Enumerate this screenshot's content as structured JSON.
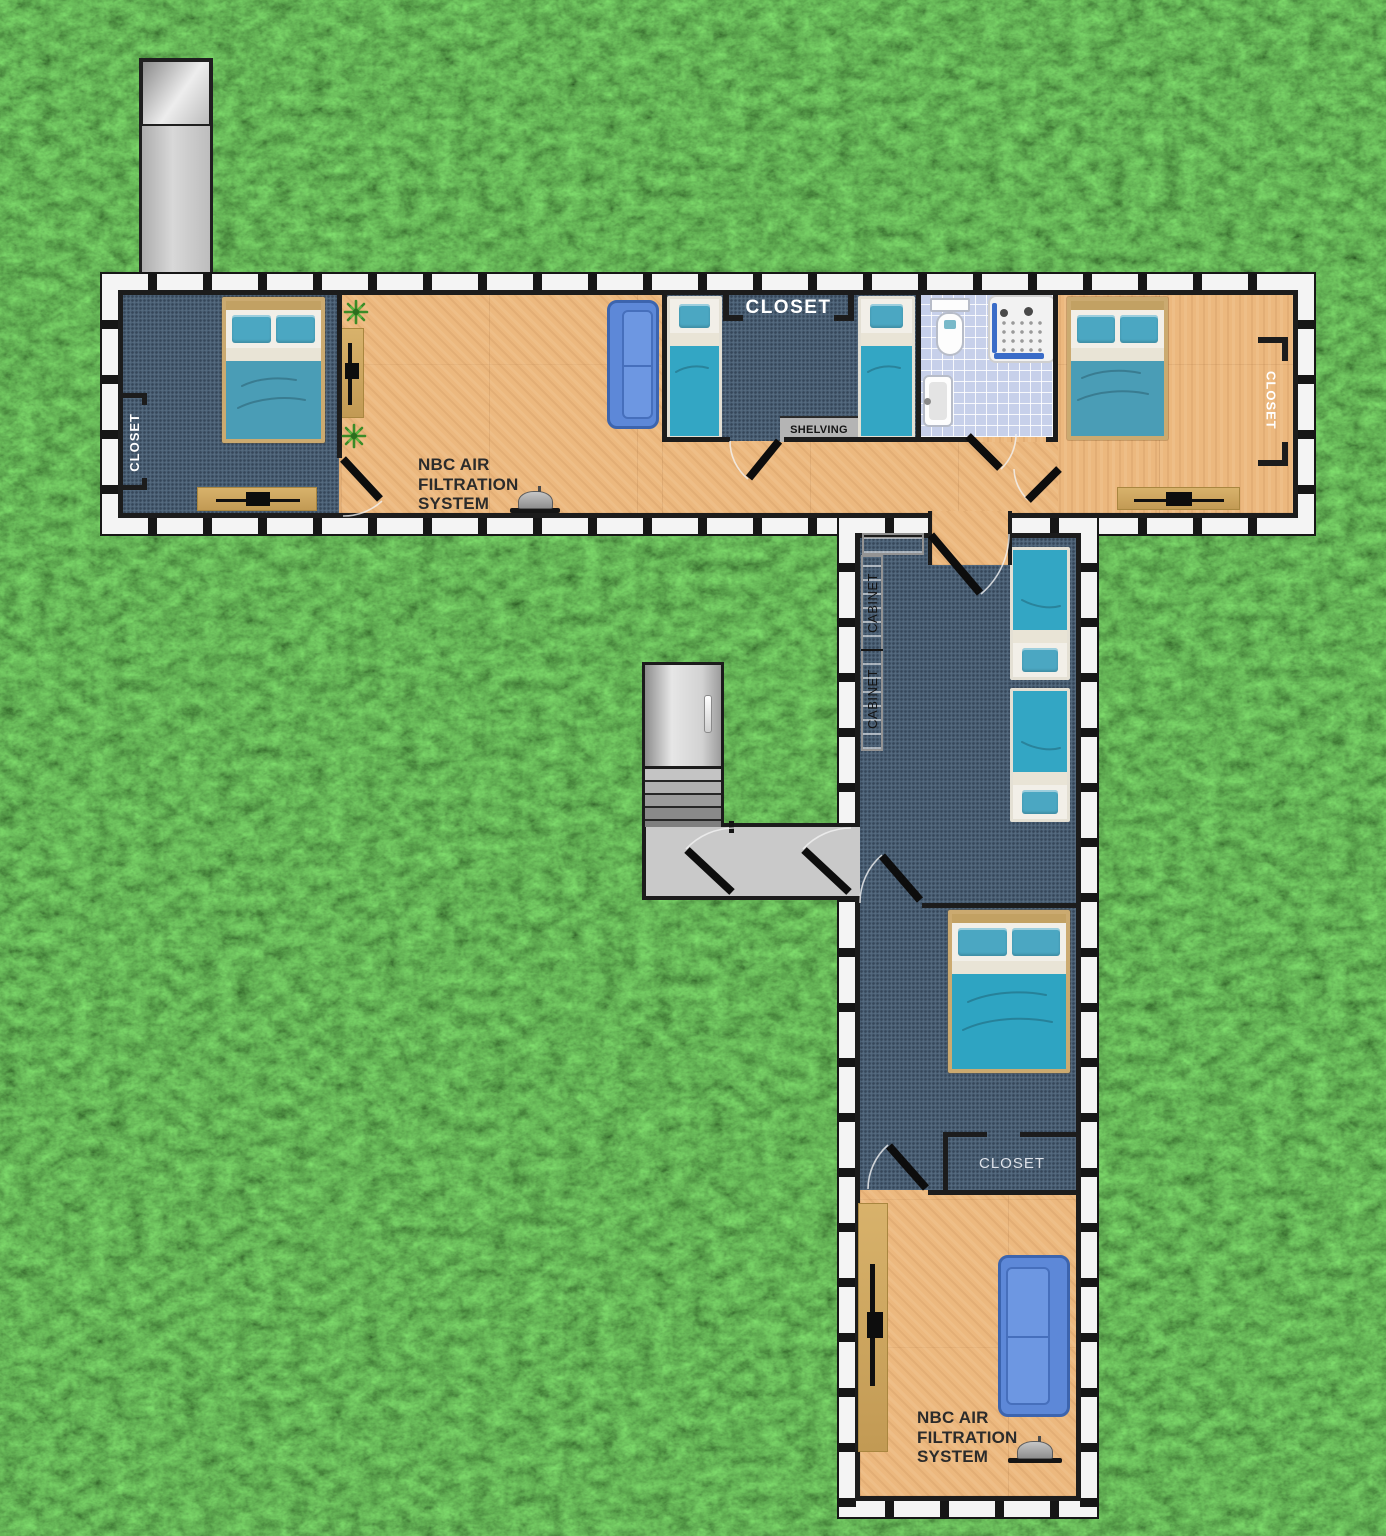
{
  "labels": {
    "top": {
      "closet_left": "CLOSET",
      "closet_center": "CLOSET",
      "shelving": "SHELVING",
      "closet_right": "CLOSET",
      "nbc": [
        "NBC AIR",
        "FILTRATION",
        "SYSTEM"
      ]
    },
    "vertical": {
      "cabinet_upper": "CABINET",
      "cabinet_lower": "CABINET",
      "closet": "CLOSET",
      "nbc": [
        "NBC AIR",
        "FILTRATION",
        "SYSTEM"
      ]
    }
  },
  "colors": {
    "grass_green": "#3f9427",
    "wood_floor": "#ecb87e",
    "carpet_blue": "#4d6378",
    "tile_blue": "#c7d0ea",
    "bed_teal": "#2ea4c2",
    "couch_blue": "#5d88d8",
    "console_tan": "#cfa65f",
    "cabinet_gray": "#c9c9c9",
    "wall_black": "#1c1c1c"
  }
}
